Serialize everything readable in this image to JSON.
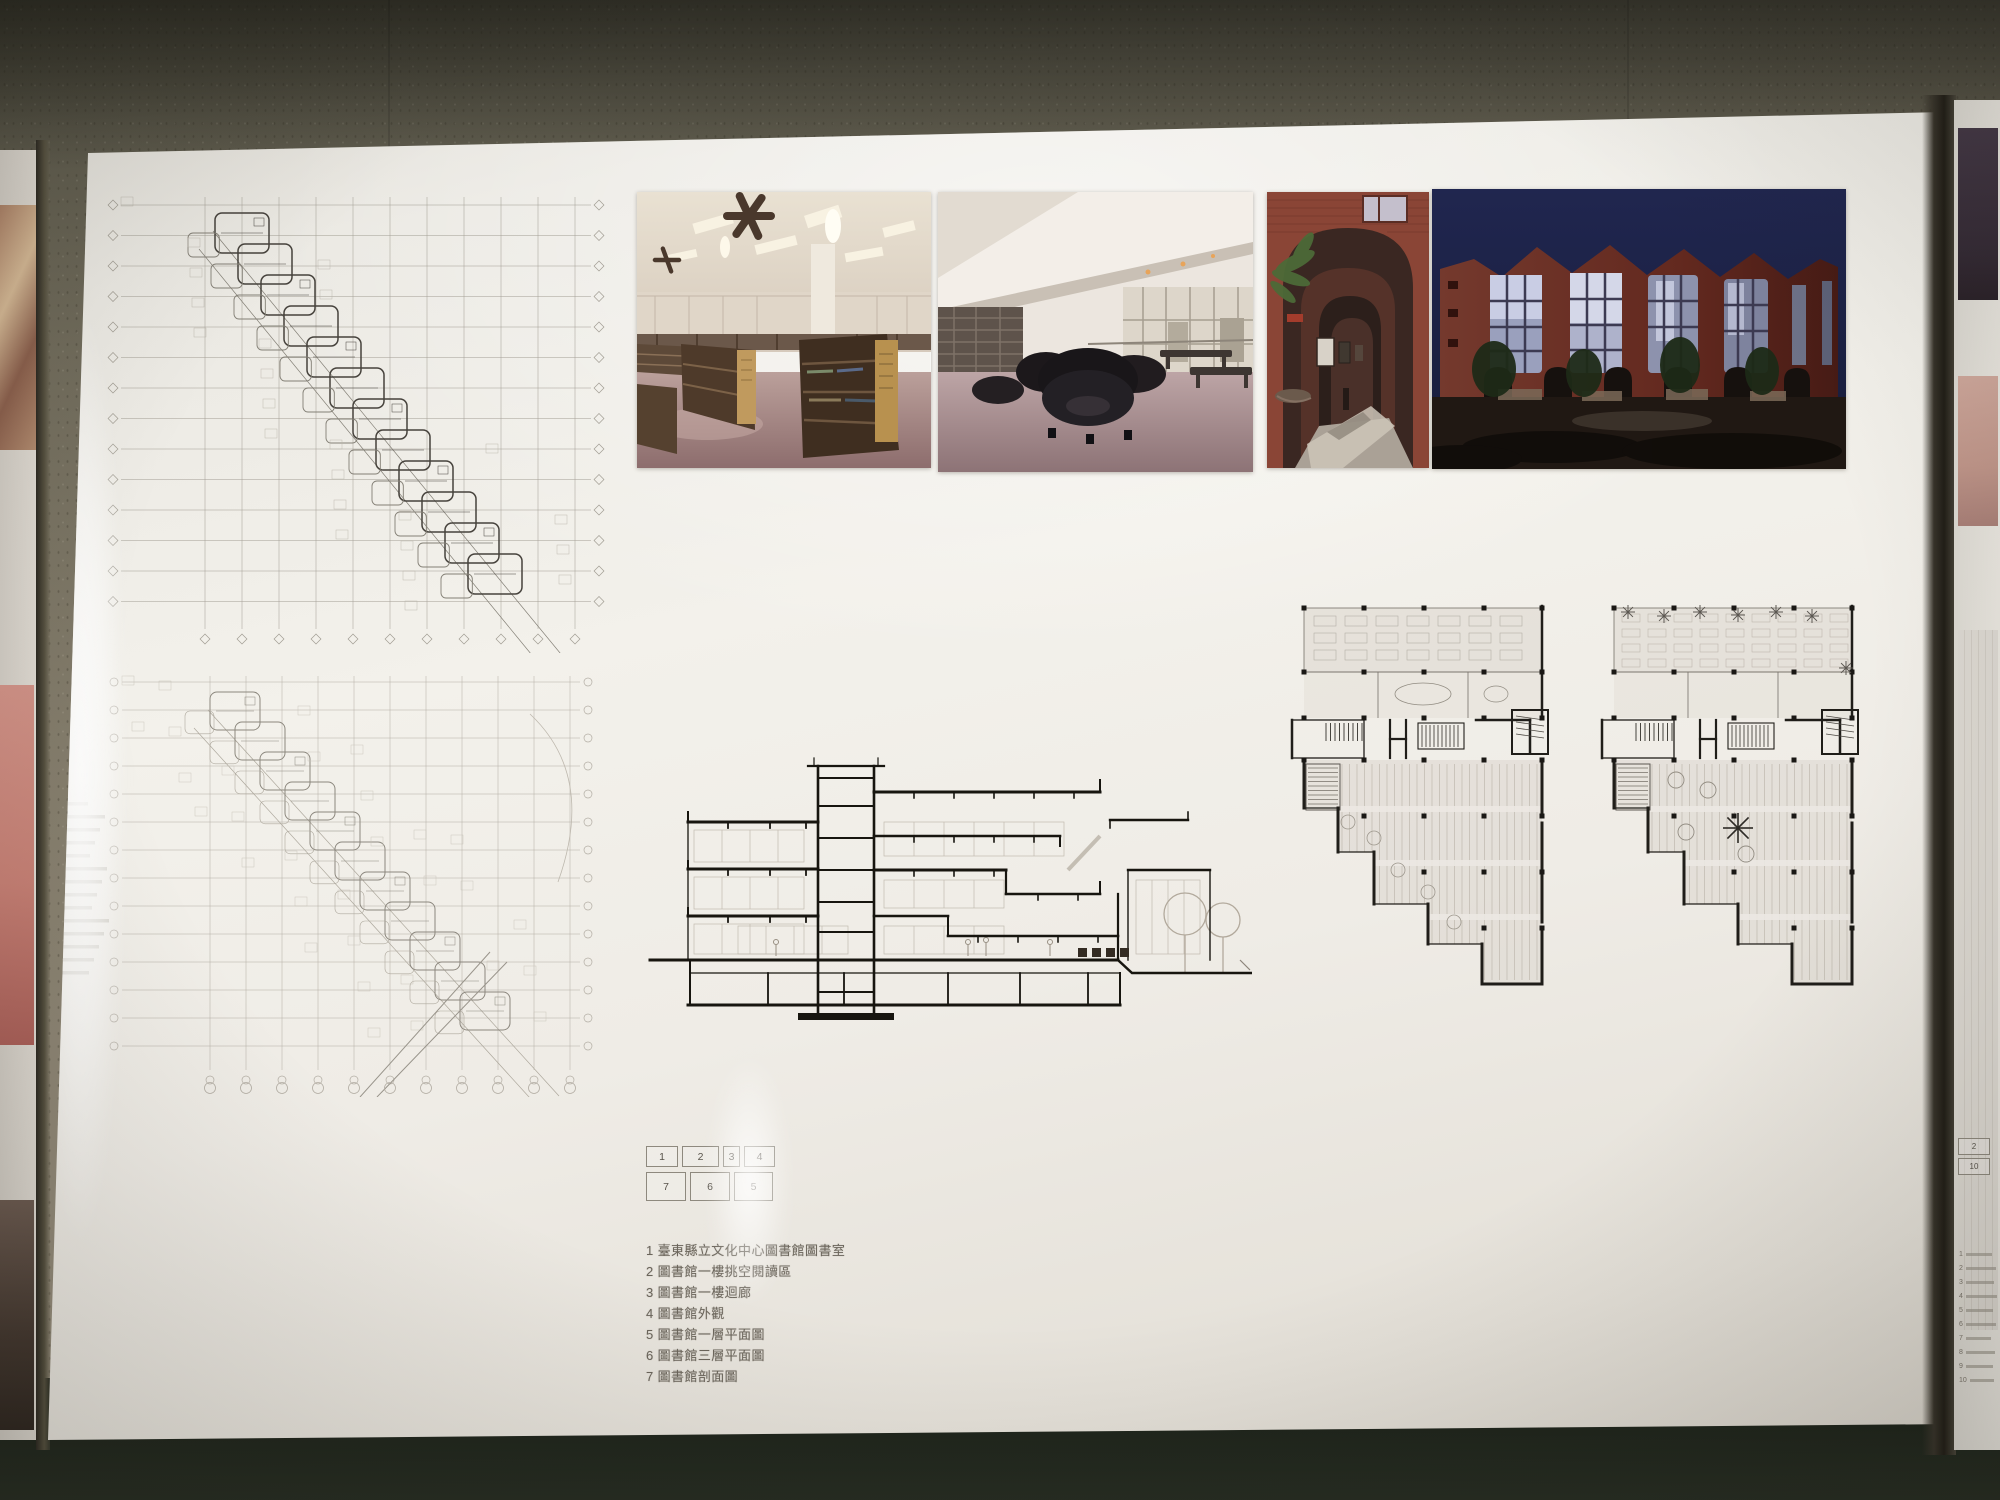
{
  "board": {
    "key_map": {
      "labels": [
        "1",
        "2",
        "3",
        "4",
        "7",
        "6",
        "5"
      ]
    },
    "captions": [
      "1 臺東縣立文化中心圖書館圖書室",
      "2 圖書館一樓挑空閱讀區",
      "3 圖書館一樓迴廊",
      "4 圖書館外觀",
      "5 圖書館一層平面圖",
      "6 圖書館三層平面圖",
      "7 圖書館剖面圖"
    ],
    "photos": [
      {
        "name": "library-reading-room-interior"
      },
      {
        "name": "double-height-reading-area-interior"
      },
      {
        "name": "brick-arcade-corridor"
      },
      {
        "name": "library-exterior-at-night"
      }
    ],
    "drawings": [
      {
        "name": "diagonal-floor-plan-upper"
      },
      {
        "name": "diagonal-floor-plan-lower"
      },
      {
        "name": "building-section"
      },
      {
        "name": "stepped-floor-plan-left"
      },
      {
        "name": "stepped-floor-plan-right"
      }
    ]
  },
  "right_board": {
    "box_labels": [
      "2",
      "10"
    ],
    "caption_numbers": [
      "1",
      "2",
      "3",
      "4",
      "5",
      "6",
      "7",
      "8",
      "9",
      "10"
    ]
  },
  "colors": {
    "wall": "#837c6b",
    "board_white": "#efece6",
    "drawing_ink": "#38342e",
    "brick_red": "#8a4536",
    "night_sky": "#1d2347",
    "photo_floor_mauve": "#a98f91",
    "shelf_brown": "#4e3a2a"
  }
}
